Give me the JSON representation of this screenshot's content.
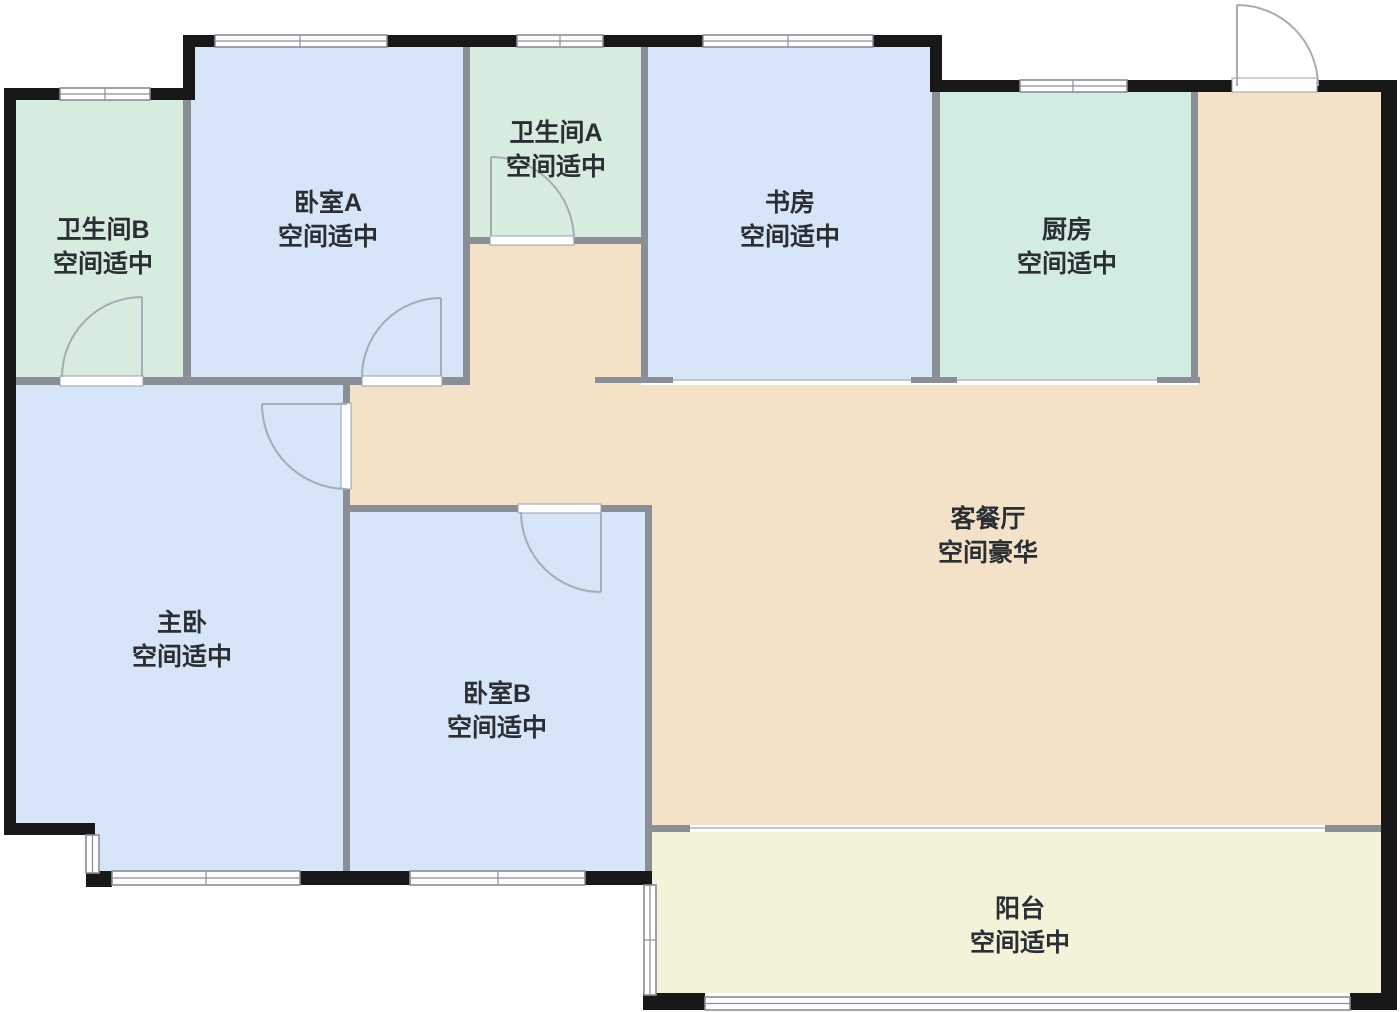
{
  "plan": {
    "kind": "apartment-floor-plan",
    "language": "zh-CN"
  },
  "rooms": [
    {
      "id": "bathroom-b",
      "name": "卫生间B",
      "assessment": "空间适中"
    },
    {
      "id": "bedroom-a",
      "name": "卧室A",
      "assessment": "空间适中"
    },
    {
      "id": "bathroom-a",
      "name": "卫生间A",
      "assessment": "空间适中"
    },
    {
      "id": "study",
      "name": "书房",
      "assessment": "空间适中"
    },
    {
      "id": "kitchen",
      "name": "厨房",
      "assessment": "空间适中"
    },
    {
      "id": "living-dining",
      "name": "客餐厅",
      "assessment": "空间豪华"
    },
    {
      "id": "master-bedroom",
      "name": "主卧",
      "assessment": "空间适中"
    },
    {
      "id": "bedroom-b",
      "name": "卧室B",
      "assessment": "空间适中"
    },
    {
      "id": "balcony",
      "name": "阳台",
      "assessment": "空间适中"
    }
  ],
  "colors": {
    "background": "#ffffff",
    "bedroom_fill": "#d7e5f9",
    "bathroom_fill": "#d5ecdf",
    "kitchen_fill": "#d2ece2",
    "living_fill": "#f3e1c8",
    "balcony_fill": "#f4f3da",
    "exterior_wall": "#181818",
    "interior_wall": "#8a8e96",
    "opening_line": "#c3c7cd",
    "door_frame": "#9aa0a8",
    "door_stroke": "#a6acb4",
    "label_text": "#2b2f34"
  }
}
